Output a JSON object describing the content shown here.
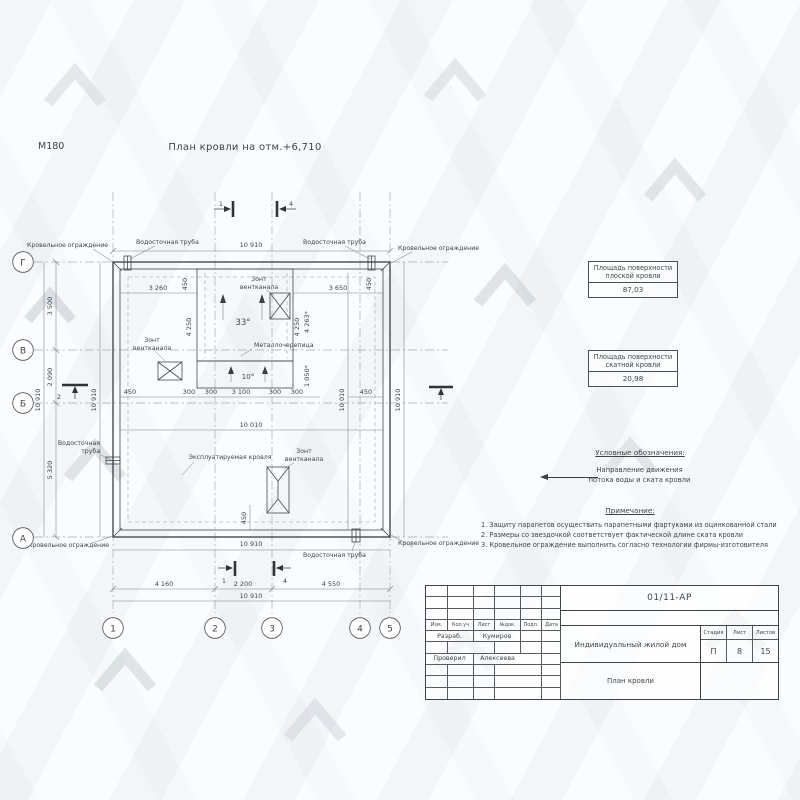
{
  "meta": {
    "scale": "М180",
    "title": "План кровли на отм.+6,710"
  },
  "plan": {
    "labels": {
      "fence": "Кровельное ограждение",
      "pipe": "Водосточная труба",
      "pipe_l1": "Водосточная",
      "pipe_l2": "труба",
      "vent_l1": "Зонт",
      "vent_l2": "вентканала",
      "metal": "Металлочерепица",
      "exploited": "Эксплуатируемая кровля",
      "slope_main": "33°",
      "slope_band": "10°"
    },
    "dims": {
      "top_total": "10 910",
      "top_left": "3 260",
      "top_right": "3 650",
      "set_left": "450",
      "set_right": "450",
      "slope_l": "4 250",
      "slope_r": "4 250",
      "slope_star": "4 263*",
      "band_star": "1 050*",
      "w450": "450",
      "s300a": "300",
      "s300b": "300",
      "s3100": "3 100",
      "s300c": "300",
      "s300d": "300",
      "e450": "450",
      "inner_w": "10 010",
      "inner_h": "10 010",
      "left_total": "10 910",
      "left_inner": "10 910",
      "gv": "3 500",
      "vb": "2 090",
      "ba": "5 320",
      "right_total": "10 910",
      "bot_set": "450",
      "bot_inner": "10 910",
      "bay1": "4 160",
      "bay2": "2 200",
      "bay3": "4 550",
      "bot_total": "10 910"
    },
    "axes": {
      "r0": "Г",
      "r1": "В",
      "r2": "Б",
      "r3": "А",
      "c0": "1",
      "c1": "2",
      "c2": "3",
      "c3": "4",
      "c4": "5"
    },
    "sections": {
      "t1": "1",
      "t4": "4",
      "b1": "1",
      "b4": "4",
      "l2": "2"
    }
  },
  "area_boxes": {
    "flat": {
      "l1": "Площадь поверхности",
      "l2": "плоской кровли",
      "value": "87,03"
    },
    "pitched": {
      "l1": "Площадь поверхности",
      "l2": "скатной кровли",
      "value": "20,98"
    }
  },
  "legend": {
    "heading": "Условные обозначения:",
    "l1": "Направление движения",
    "l2": "потока воды и ската кровли"
  },
  "notes": {
    "heading": "Примечание:",
    "items": [
      "1. Защиту парапетов осуществить парапетными фартуками из оцинкованной стали",
      "2. Размеры со звездочкой соответствует фактической длине ската кровли",
      "3. Кровельное ограждение выполнить согласно технологии фирмы-изготовителя"
    ]
  },
  "titleblock": {
    "doc": "01/11-АР",
    "cols": [
      "Изм.",
      "Кол.уч",
      "Лист",
      "№док.",
      "Подп.",
      "Дата"
    ],
    "row1_role": "Разраб.",
    "row1_name": "Кумиров",
    "row2_role": "Проверил",
    "row2_name": "Алексеева",
    "project": "Индивидуальный жилой дом",
    "title": "План кровли",
    "stage_h": "Стадия",
    "sheet_h": "Лист",
    "sheets_h": "Листов",
    "stage": "П",
    "sheet": "8",
    "sheets": "15"
  }
}
